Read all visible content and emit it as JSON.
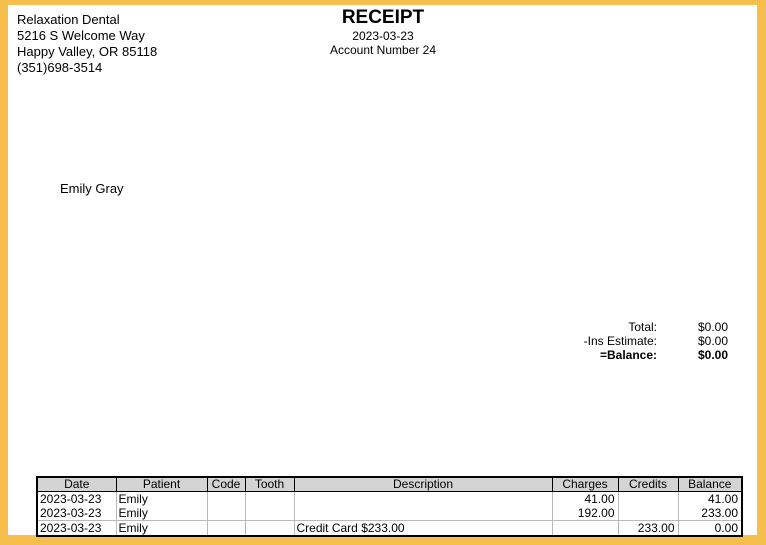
{
  "colors": {
    "frame": "#f6bf4d",
    "table_header_bg": "#d4d4d4",
    "grid_line": "#b9b9b9"
  },
  "provider": {
    "name": "Relaxation Dental",
    "address_line1": "5216 S Welcome Way",
    "address_line2": "Happy Valley, OR 85118",
    "phone": "(351)698-3514"
  },
  "header": {
    "title": "RECEIPT",
    "date": "2023-03-23",
    "account": "Account Number 24"
  },
  "patient": {
    "name": "Emily Gray"
  },
  "totals": {
    "rows": [
      {
        "label": "Total:",
        "value": "$0.00"
      },
      {
        "label": "-Ins Estimate:",
        "value": "$0.00"
      },
      {
        "label": "=Balance:",
        "value": "$0.00"
      }
    ]
  },
  "table": {
    "columns": [
      "Date",
      "Patient",
      "Code",
      "Tooth",
      "Description",
      "Charges",
      "Credits",
      "Balance"
    ],
    "rows": [
      {
        "date": "2023-03-23",
        "patient": "Emily",
        "code": "",
        "tooth": "",
        "description": "",
        "charges": "41.00",
        "credits": "",
        "balance": "41.00"
      },
      {
        "date": "2023-03-23",
        "patient": "Emily",
        "code": "",
        "tooth": "",
        "description": "",
        "charges": "192.00",
        "credits": "",
        "balance": "233.00"
      },
      {
        "date": "2023-03-23",
        "patient": "Emily",
        "code": "",
        "tooth": "",
        "description": "Credit Card $233.00",
        "charges": "",
        "credits": "233.00",
        "balance": "0.00"
      }
    ]
  }
}
